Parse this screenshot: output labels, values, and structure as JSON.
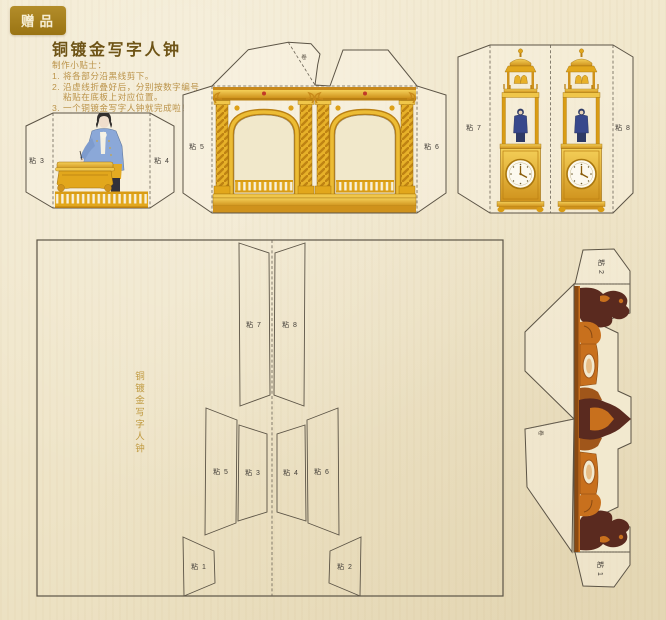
{
  "badge": "赠品",
  "title": "铜镀金写字人钟",
  "instructions": {
    "lines": [
      "制作小贴士：",
      "1. 将各部分沿黑线剪下。",
      "2. 沿虚线折叠好后，分别按数字编号",
      "粘贴在底板上对应位置。",
      "3. 一个铜镀金写字人钟就完成啦！"
    ]
  },
  "tabs": {
    "t1": "粘 1",
    "t2": "粘 2",
    "t3": "粘 3",
    "t4": "粘 4",
    "t5": "粘 5",
    "t6": "粘 6",
    "t7": "粘 7",
    "t8": "粘 8"
  },
  "fold_mark": "卷",
  "board_title": "铜镀金写字人钟",
  "colors": {
    "paper": "#efe5c9",
    "badge_gold": "#a7801c",
    "title_text": "#6e5416",
    "hint_text": "#bb9349",
    "board_text": "#c09a40",
    "cut_line": "#5c5446",
    "artwork_gold": "#e2a71c",
    "artwork_gold_dark": "#b97f12",
    "coat_blue": "#8ba8d8",
    "figure_blue": "#38488c",
    "ornament_maroon": "#5a2a1f",
    "ornament_orange": "#c8701d",
    "gem_red": "#c23a28",
    "clock_face": "#fcf9ef"
  }
}
